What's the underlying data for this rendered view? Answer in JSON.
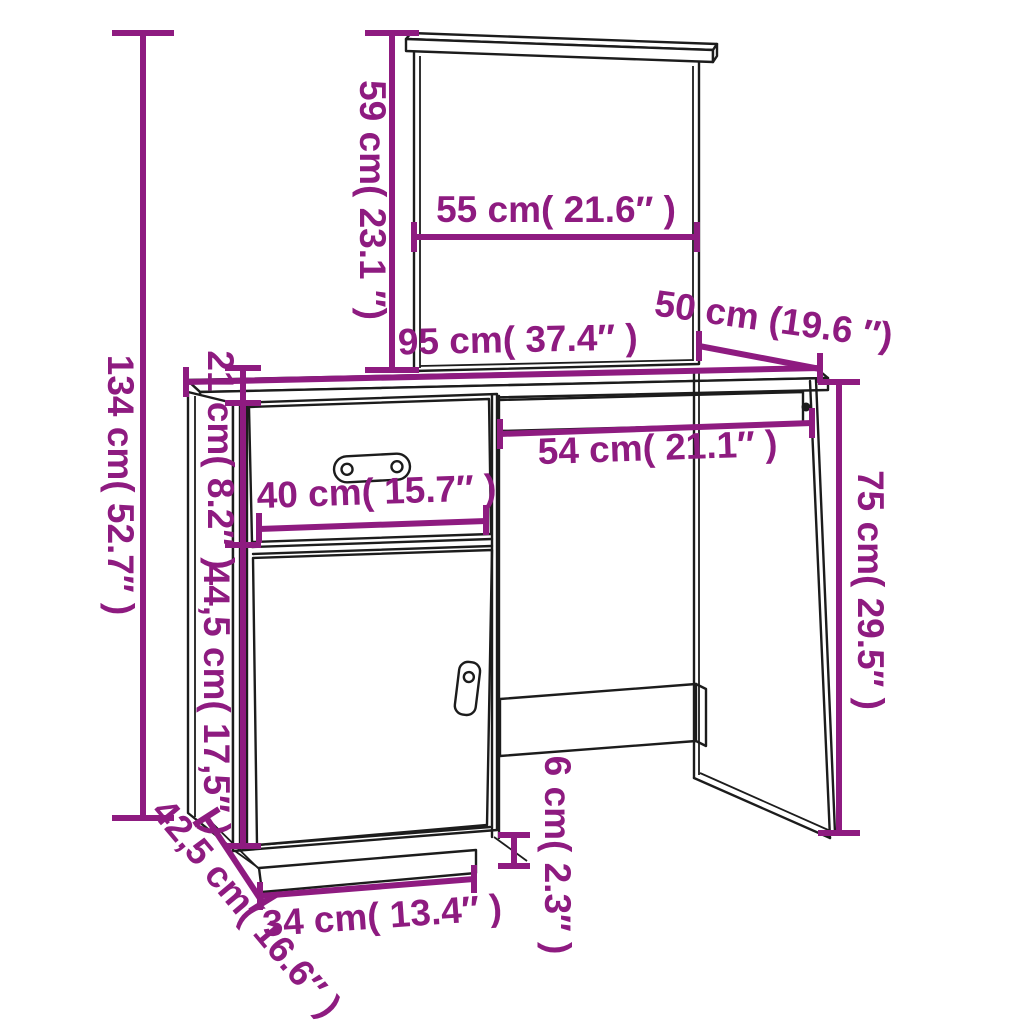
{
  "subject": "dressing-table-with-mirror-dimension-diagram",
  "accent_color": "#8E1B80",
  "line_color": "#1c1c1c",
  "background_color": "#ffffff",
  "unit_system": "cm with inch conversion",
  "dimensions": {
    "total_height": "134 cm( 52.7″ )",
    "mirror_height": "59 cm( 23.1 ″)",
    "mirror_width": "55 cm( 21.6″ )",
    "desk_width": "95 cm( 37.4″ )",
    "desk_depth": "50 cm (19.6 ″)",
    "drawer_front_height": "21 cm( 8.2″ )",
    "knee_space_width": "54 cm( 21.1″ )",
    "drawer_width": "40 cm( 15.7″ )",
    "door_height": "44,5 cm( 17,5″ )",
    "desk_height": "75 cm( 29.5″ )",
    "side_depth": "42,5 cm( 16.6″ )",
    "plinth_width": "34 cm( 13.4″ )",
    "plinth_height": "6 cm( 2.3″ )"
  }
}
